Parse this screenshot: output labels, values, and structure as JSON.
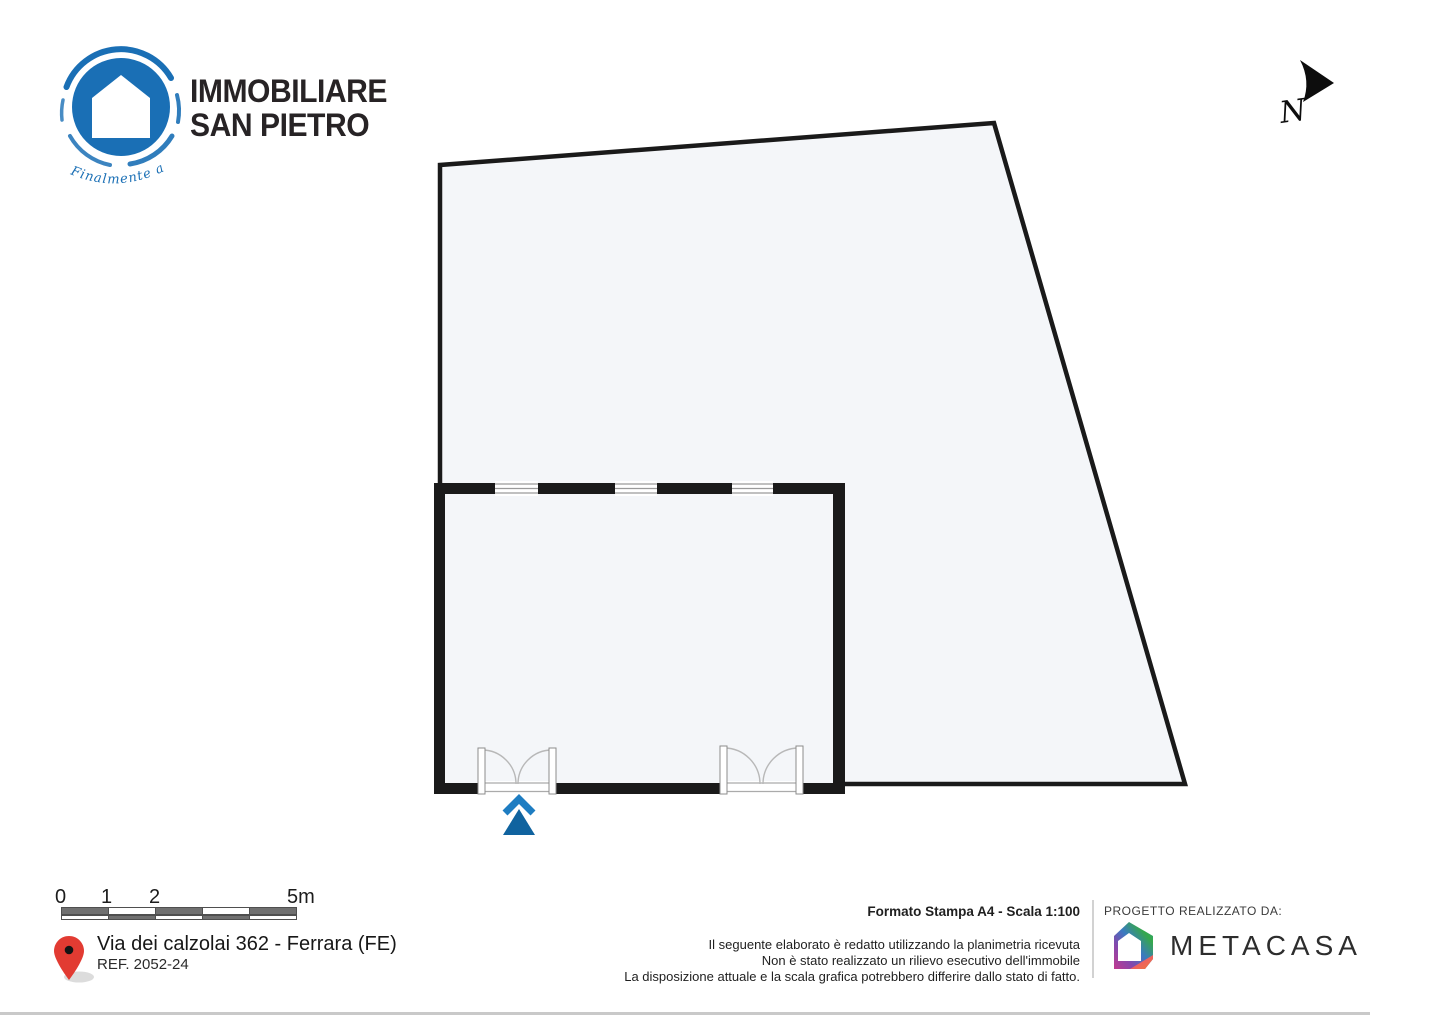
{
  "brand": {
    "line1": "IMMOBILIARE",
    "line2": "SAN PIETRO",
    "tagline": "Finalmente a Casa",
    "blue": "#1a6fb5"
  },
  "north": {
    "label": "N"
  },
  "plan": {
    "fill": "#f4f6f9",
    "outline": "#1a1a1a",
    "entrance_arrow_light": "#1e7dc2",
    "entrance_arrow_dark": "#10639f",
    "windows_count": 3,
    "doors_count": 2
  },
  "scalebar": {
    "labels": [
      "0",
      "1",
      "2",
      "5m"
    ],
    "dark": "#707070",
    "light": "#ffffff"
  },
  "address": {
    "street": "Via dei calzolai 362 - Ferrara (FE)",
    "ref": "REF. 2052-24",
    "pin_red": "#e23b32"
  },
  "print": {
    "format": "Formato Stampa A4 - Scala 1:100",
    "disclaimer": [
      "Il seguente elaborato è redatto utilizzando la planimetria ricevuta",
      "Non è stato realizzato un rilievo esecutivo dell'immobile",
      "La disposizione attuale e la scala grafica potrebbero differire dallo stato di fatto."
    ]
  },
  "credits": {
    "heading": "PROGETTO REALIZZATO DA:",
    "company": "METACASA"
  }
}
